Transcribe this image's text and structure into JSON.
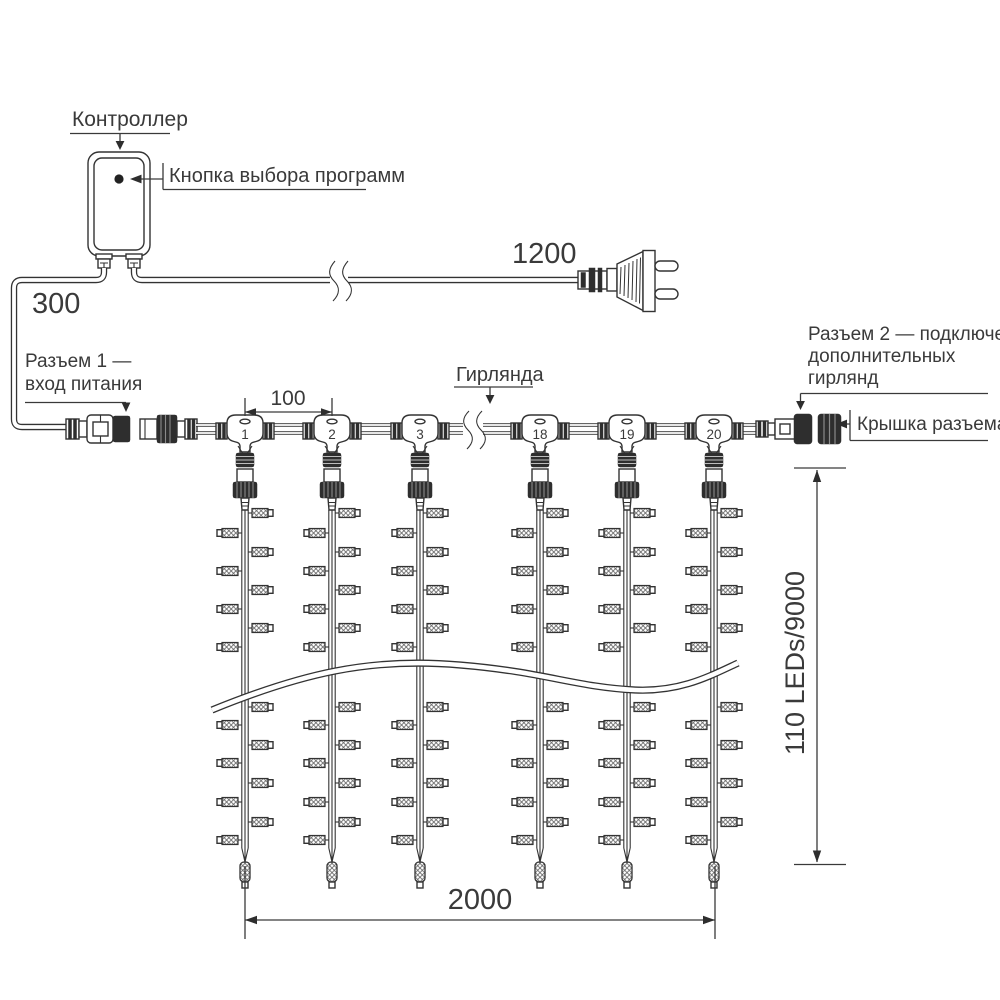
{
  "diagram_title": "LED curtain garland connection diagram",
  "labels": {
    "controller": "Контроллер",
    "program_button": "Кнопка выбора программ",
    "dim_300": "300",
    "dim_1200": "1200",
    "connector1_line1": "Разъем 1 —",
    "connector1_line2": "вход питания",
    "garland": "Гирлянда",
    "dim_100": "100",
    "connector2_line1": "Разъем 2 — подключение",
    "connector2_line2": "дополнительных",
    "connector2_line3": "гирлянд",
    "connector_cap": "Крышка разъема",
    "vertical_dim": "110 LEDs/9000",
    "dim_2000": "2000"
  },
  "garland": {
    "connector_numbers": [
      "1",
      "2",
      "3",
      "18",
      "19",
      "20"
    ],
    "strings_shown": 6,
    "bulbs_per_string_shown": 16
  },
  "colors": {
    "line": "#333333",
    "dark_fill": "#2e2e2e",
    "background": "#ffffff"
  }
}
